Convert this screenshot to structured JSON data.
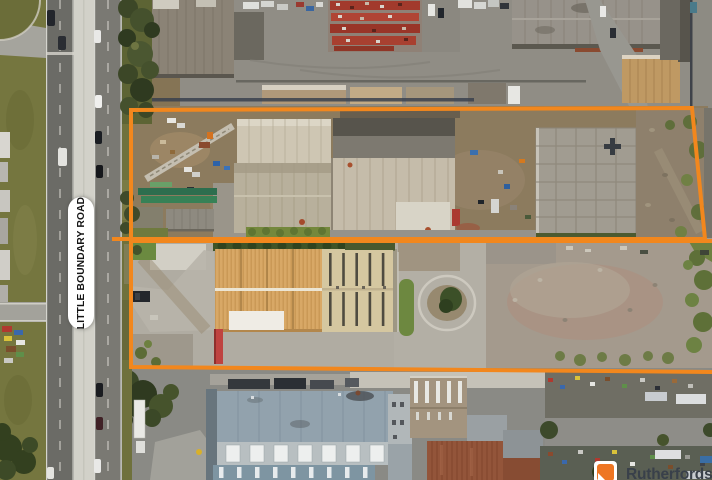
{
  "road_label": {
    "text": "LITTLE BOUNDARY ROAD"
  },
  "watermark": {
    "agency": "Rutherfords"
  },
  "colors": {
    "boundary_orange": "#F2871D",
    "road_label_bg": "#FFFFFF",
    "road_label_text": "#151515",
    "watermark_text": "#39404A",
    "watermark_logo_orange": "#EE7623"
  }
}
